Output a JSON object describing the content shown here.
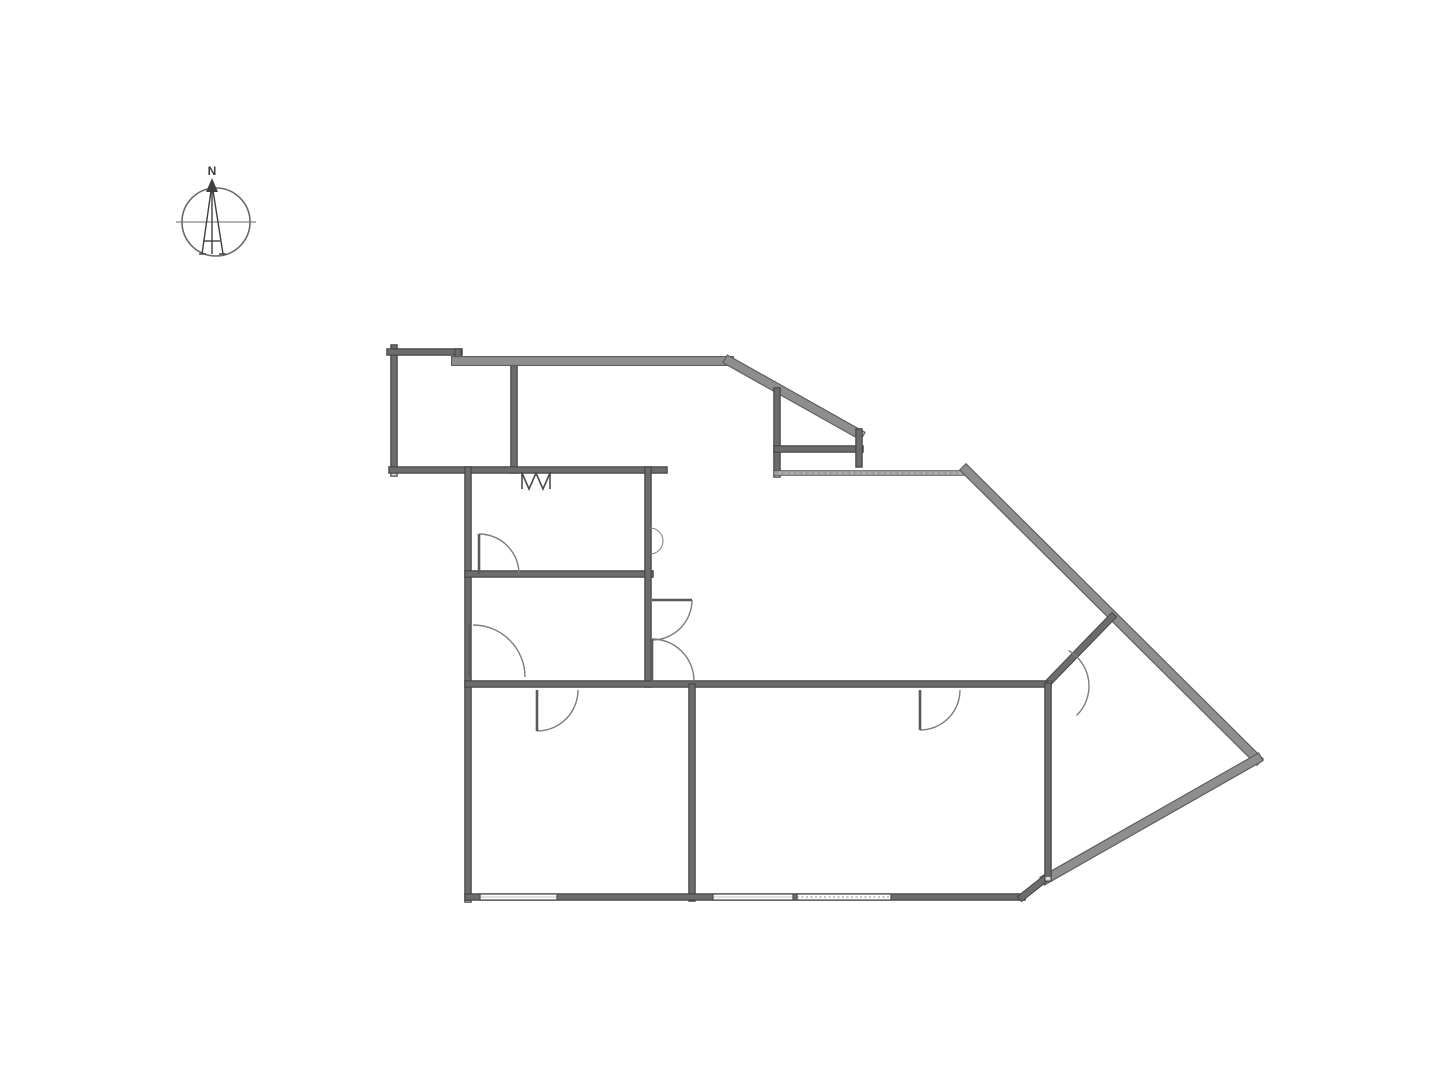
{
  "page": {
    "background": "#ffffff",
    "width": 1440,
    "height": 1080
  },
  "compass": {
    "label": "N",
    "cx": 216,
    "cy": 222,
    "r": 34,
    "ring_color": "#6a6a6a",
    "needle_color": "#3f3f3f",
    "axis": [
      176,
      222,
      256,
      222
    ],
    "needle_paths": [
      "M212,184 L202,254",
      "M212,184 L223,254",
      "M212,184 L212,254",
      "M204,241 L220,241",
      "M199,254 L206,254",
      "M219,254 L226,254"
    ],
    "apex_path": "M212,178 L206,192 L218,192 Z",
    "label_x": 212,
    "label_y": 175
  },
  "floorplan": {
    "styles": {
      "std": {
        "edge": "#474747",
        "edgeW": 7.5,
        "band": "#d9d9d9",
        "bandW": 5,
        "hatch": "#3e3e3e",
        "dash": "2.5 3.5",
        "hatchOpacity": 0.7
      },
      "thick": {
        "edge": "#5e5e5e",
        "edgeW": 10,
        "band": "#c7c7c7",
        "bandW": 7.5,
        "hatch": "#4a4a4a",
        "dash": "2 6",
        "hatchOpacity": 0.45
      },
      "thin": {
        "edge": "#565656",
        "edgeW": 5.5,
        "band": "#eeeeee",
        "bandW": 3.5,
        "hatch": "#555555",
        "dash": "2 4",
        "hatchOpacity": 0.5
      }
    },
    "walls": [
      {
        "name": "balcony-left-wall",
        "k": "std",
        "x1": 394,
        "y1": 348,
        "x2": 394,
        "y2": 473
      },
      {
        "name": "balcony-top-wall",
        "k": "std",
        "x1": 390,
        "y1": 352,
        "x2": 459,
        "y2": 352
      },
      {
        "name": "balcony-step",
        "k": "std",
        "x1": 458,
        "y1": 352,
        "x2": 458,
        "y2": 361
      },
      {
        "name": "balcony-right-wall",
        "k": "std",
        "x1": 514,
        "y1": 361,
        "x2": 514,
        "y2": 470
      },
      {
        "name": "long-top-wall",
        "k": "thick",
        "x1": 456,
        "y1": 361,
        "x2": 729,
        "y2": 361
      },
      {
        "name": "upper-diagonal-wall",
        "k": "thick",
        "x1": 729,
        "y1": 361,
        "x2": 859,
        "y2": 434
      },
      {
        "name": "terrace-left-wall",
        "k": "std",
        "x1": 777,
        "y1": 391,
        "x2": 777,
        "y2": 474
      },
      {
        "name": "terrace-bottom-wall",
        "k": "std",
        "x1": 777,
        "y1": 449,
        "x2": 860,
        "y2": 449
      },
      {
        "name": "terrace-right-stub",
        "k": "std",
        "x1": 859,
        "y1": 432,
        "x2": 859,
        "y2": 464
      },
      {
        "name": "mid-wall-left",
        "k": "std",
        "x1": 392,
        "y1": 470,
        "x2": 664,
        "y2": 470
      },
      {
        "name": "mid-wall-right",
        "k": "thin",
        "x1": 776,
        "y1": 473,
        "x2": 966,
        "y2": 473
      },
      {
        "name": "northeast-diagonal",
        "k": "thick",
        "x1": 966,
        "y1": 470,
        "x2": 1257,
        "y2": 759
      },
      {
        "name": "southeast-diagonal",
        "k": "thick",
        "x1": 1257,
        "y1": 759,
        "x2": 1046,
        "y2": 879
      },
      {
        "name": "interior-diagonal",
        "k": "std",
        "x1": 1112,
        "y1": 617,
        "x2": 1047,
        "y2": 684
      },
      {
        "name": "left-exterior-wall",
        "k": "std",
        "x1": 468,
        "y1": 470,
        "x2": 468,
        "y2": 899
      },
      {
        "name": "interior-wall-h1",
        "k": "std",
        "x1": 468,
        "y1": 574,
        "x2": 650,
        "y2": 574
      },
      {
        "name": "interior-wall-v1",
        "k": "std",
        "x1": 648,
        "y1": 470,
        "x2": 648,
        "y2": 684
      },
      {
        "name": "interior-wall-h2",
        "k": "std",
        "x1": 468,
        "y1": 684,
        "x2": 1048,
        "y2": 684
      },
      {
        "name": "bottom-divider-wall",
        "k": "std",
        "x1": 692,
        "y1": 687,
        "x2": 692,
        "y2": 898
      },
      {
        "name": "bottom-exterior-wall",
        "k": "std",
        "x1": 468,
        "y1": 897,
        "x2": 1022,
        "y2": 897
      },
      {
        "name": "bottom-corner-diagonal",
        "k": "std",
        "x1": 1022,
        "y1": 897,
        "x2": 1046,
        "y2": 878
      },
      {
        "name": "right-interior-wall",
        "k": "std",
        "x1": 1048,
        "y1": 686,
        "x2": 1048,
        "y2": 878
      }
    ],
    "windows": [
      {
        "name": "window-bottom-left",
        "x": 480,
        "y": 894,
        "w": 77,
        "h": 6,
        "hatched": false
      },
      {
        "name": "window-bottom-mid",
        "x": 713,
        "y": 894,
        "w": 80,
        "h": 6,
        "hatched": false
      },
      {
        "name": "window-bottom-right",
        "x": 797,
        "y": 894,
        "w": 94,
        "h": 6,
        "hatched": true
      }
    ],
    "doors": [
      {
        "name": "door-midleft-room",
        "cx": 479,
        "cy": 574,
        "r": 40,
        "a0": -90,
        "a1": 0,
        "leaf": [
          479,
          534,
          479,
          574
        ]
      },
      {
        "name": "door-left-lower",
        "cx": 473,
        "cy": 677,
        "r": 52,
        "a0": -90,
        "a1": 0,
        "leaf": [
          470,
          625,
          470,
          677
        ]
      },
      {
        "name": "door-bottomleft-room",
        "cx": 537,
        "cy": 690,
        "r": 41,
        "a0": 90,
        "a1": 0,
        "leaf": [
          537,
          690,
          537,
          731
        ]
      },
      {
        "name": "door-hall-upper",
        "cx": 652,
        "cy": 600,
        "r": 40,
        "a0": 0,
        "a1": 90,
        "leaf": [
          652,
          600,
          692,
          600
        ]
      },
      {
        "name": "door-hall-lower",
        "cx": 652,
        "cy": 681,
        "r": 42,
        "a0": -90,
        "a1": 0,
        "leaf": [
          652,
          639,
          652,
          681
        ]
      },
      {
        "name": "door-bottommid-room",
        "cx": 920,
        "cy": 690,
        "r": 40,
        "a0": 90,
        "a1": 0,
        "leaf": [
          920,
          690,
          920,
          730
        ]
      },
      {
        "name": "door-diagonal-room",
        "cx": 1048,
        "cy": 686,
        "r": 41,
        "a0": -60,
        "a1": 46,
        "leaf": null
      },
      {
        "name": "wall-notch-arc",
        "cx": 650,
        "cy": 541,
        "r": 13,
        "a0": -90,
        "a1": 90,
        "leaf": null,
        "thin": true
      }
    ],
    "fold_symbol": {
      "name": "folding-door-symbol",
      "polylines": [
        "522,472 522,489",
        "522,473 529,489 536,473 543,489 550,473",
        "550,472 550,489"
      ],
      "color": "#4a4a4a"
    },
    "door_arc_color": "#7d7d7d",
    "door_leaf_color": "#5a5a5a",
    "window_edge_color": "#4a4a4a"
  }
}
